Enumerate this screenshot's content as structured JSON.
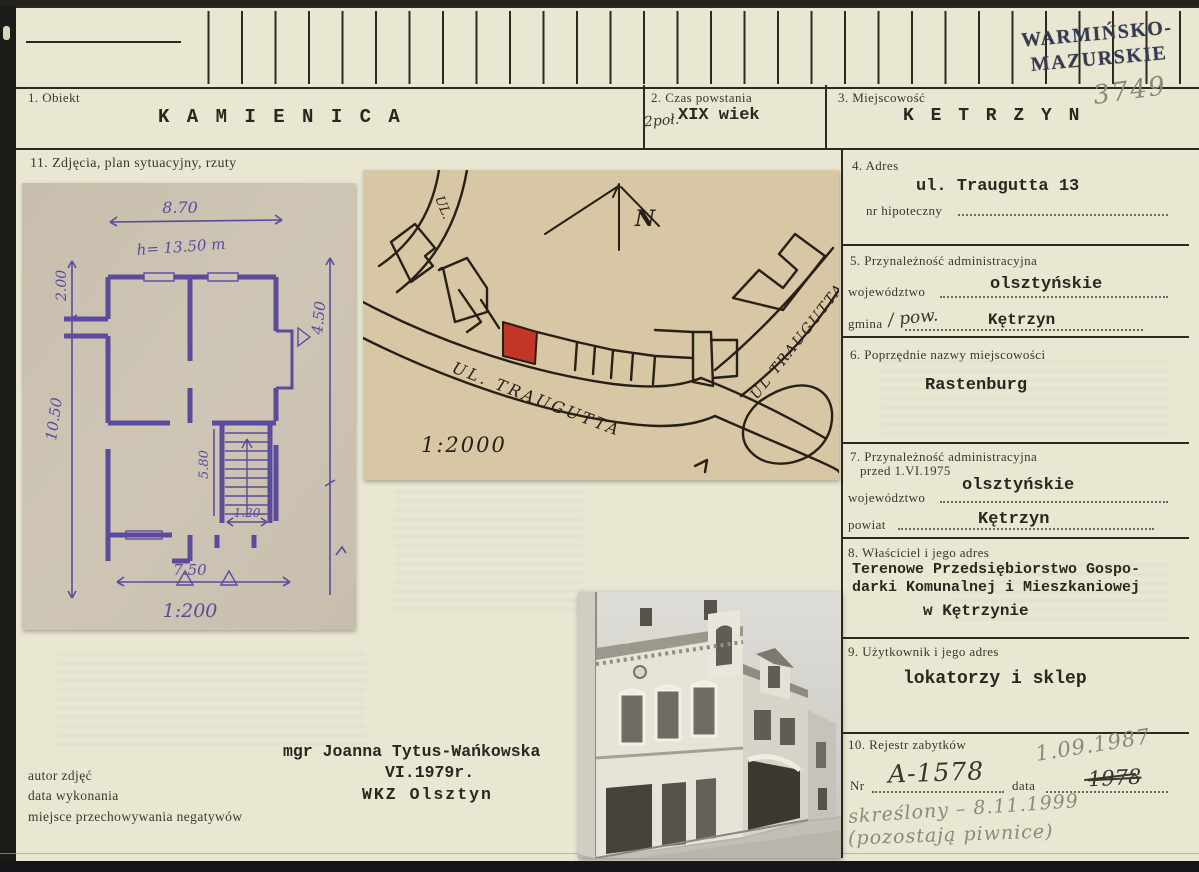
{
  "stamp": {
    "line1": "WARMIŃSKO-",
    "line2": "MAZURSKIE"
  },
  "ref_number": "3749",
  "fields": {
    "f1": {
      "label": "1. Obiekt",
      "value": "K A M I E N I C A"
    },
    "f2": {
      "label": "2. Czas powstania",
      "hand": "2poł.",
      "value": "XIX wiek"
    },
    "f3": {
      "label": "3. Miejscowość",
      "value": "K E T R Z Y N"
    },
    "f4": {
      "label": "4. Adres",
      "value": "ul. Traugutta 13",
      "hipo": "nr hipoteczny"
    },
    "f5": {
      "label": "5. Przynależność administracyjna",
      "l1": "województwo",
      "v1": "olsztyńskie",
      "l2": "gmina",
      "hand": "/ pow.",
      "v2": "Kętrzyn"
    },
    "f6": {
      "label": "6. Poprzędnie nazwy miejscowości",
      "value": "Rastenburg"
    },
    "f7": {
      "label": "7. Przynależność administracyjna",
      "label2": "przed 1.VI.1975",
      "l1": "województwo",
      "v1": "olsztyńskie",
      "l2": "powiat",
      "v2": "Kętrzyn"
    },
    "f8": {
      "label": "8. Właściciel i jego adres",
      "line1": "Terenowe Przedsiębiorstwo Gospo-",
      "line2": "darki Komunalnej i Mieszkaniowej",
      "line3": "w Kętrzynie"
    },
    "f9": {
      "label": "9. Użytkownik i jego adres",
      "value": "lokatorzy i sklep"
    },
    "f10": {
      "label": "10. Rejestr zabytków",
      "nr_label": "Nr",
      "nr_value": "A-1578",
      "date_label": "data",
      "date_old": "1978",
      "date_new": "1.09.1987",
      "note1": "skreślony – 8.11.1999",
      "note2": "(pozostają piwnice)"
    },
    "f11": {
      "label": "11. Zdjęcia, plan sytuacyjny, rzuty"
    }
  },
  "floor_plan": {
    "dim_top": "8.70",
    "dim_height": "h= 13.50 m",
    "dim_left_top": "2.00",
    "dim_left": "10.50",
    "dim_right": "4.50",
    "dim_stair": "5.80",
    "dim_door": "1.20",
    "dim_bottom": "7.50",
    "scale": "1:200"
  },
  "site_plan": {
    "north": "N",
    "street_small": "UL.",
    "street_main": "UL. TRAUGUTTA",
    "street_right": "UL TRAUGUTTA",
    "scale": "1:2000"
  },
  "credits": {
    "labels": [
      "autor zdjęć",
      "data wykonania",
      "miejsce przechowywania negatywów"
    ],
    "name": "mgr Joanna Tytus-Wańkowska",
    "date": "VI.1979r.",
    "place": "WKZ Olsztyn"
  }
}
